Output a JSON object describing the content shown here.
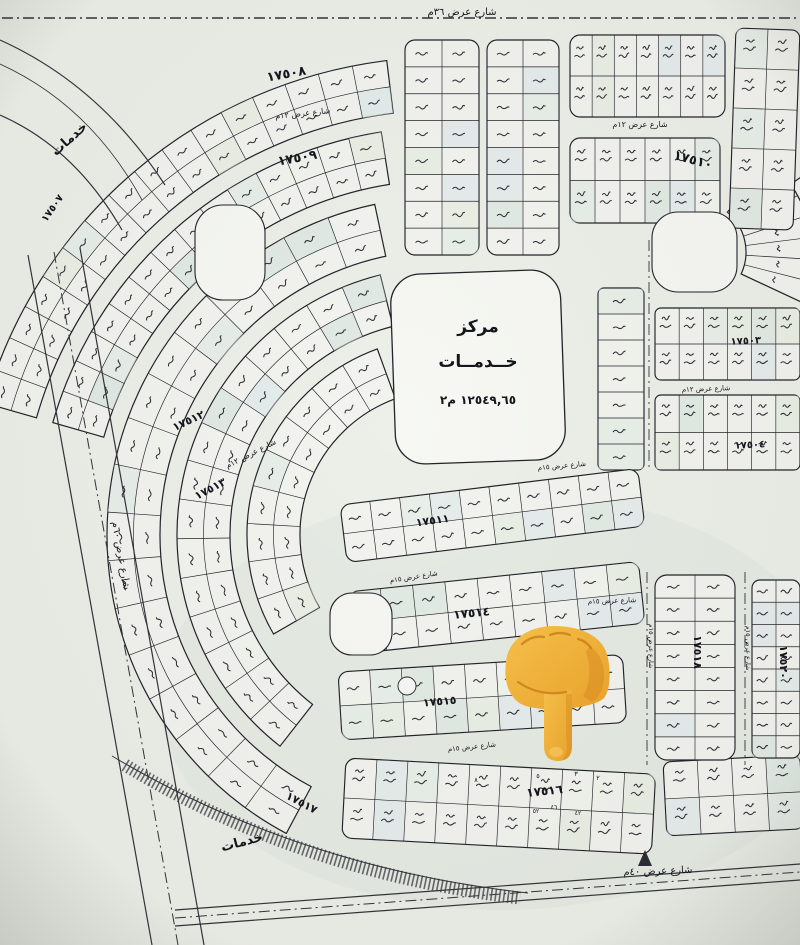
{
  "map_title": "مخطط أراضي سكني",
  "top_boundary_street": "شارع عرض ٣٦م",
  "center_plot": {
    "title_line1": "مركز",
    "title_line2": "خــدمــات",
    "area_text": "١٢٥٤٩,٦٥ م٢"
  },
  "pointer": {
    "icon": "backhand-index-pointing-down-emoji",
    "body_color": "#F3AC35",
    "shade_color": "#D9881F",
    "light_color": "#F9C75A"
  },
  "street_labels": [
    {
      "t": "شارع عرض ٣٦م",
      "x": 462,
      "y": 15,
      "r": 0,
      "s": 10
    },
    {
      "t": "شارع عرض ١٢م",
      "x": 303,
      "y": 116,
      "r": -6,
      "s": 8
    },
    {
      "t": "شارع عرض ١٢م",
      "x": 640,
      "y": 127,
      "r": 0,
      "s": 8
    },
    {
      "t": "شارع عرض ١٢م",
      "x": 706,
      "y": 391,
      "r": -2,
      "s": 7
    },
    {
      "t": "شارع عرض ١٢م",
      "x": 252,
      "y": 456,
      "r": -27,
      "s": 8
    },
    {
      "t": "شارع عرض ١٥م",
      "x": 562,
      "y": 468,
      "r": -5,
      "s": 7
    },
    {
      "t": "شارع عرض ١٥م",
      "x": 414,
      "y": 579,
      "r": -9,
      "s": 7
    },
    {
      "t": "شارع عرض ١٥م",
      "x": 612,
      "y": 603,
      "r": -2,
      "s": 7
    },
    {
      "t": "شارع عرض ١٥م",
      "x": 649,
      "y": 646,
      "r": 90,
      "s": 6.5
    },
    {
      "t": "شارع عرض ١٥م",
      "x": 746,
      "y": 648,
      "r": 90,
      "s": 6.5
    },
    {
      "t": "شارع عرض ١٥م",
      "x": 472,
      "y": 749,
      "r": -6,
      "s": 7
    },
    {
      "t": "شارع عرض ٤٠م",
      "x": 658,
      "y": 874,
      "r": -2,
      "s": 10
    },
    {
      "t": "شارع عرض ٦٠م",
      "x": 118,
      "y": 556,
      "r": 80,
      "s": 10
    }
  ],
  "block_labels": [
    {
      "t": "١٧٥٠٧",
      "x": 55,
      "y": 210,
      "r": -55,
      "s": 10
    },
    {
      "t": "١٧٥٠٨",
      "x": 287,
      "y": 78,
      "r": -10,
      "s": 13
    },
    {
      "t": "١٧٥٠٩",
      "x": 298,
      "y": 162,
      "r": -10,
      "s": 13
    },
    {
      "t": "١٧٥١٠",
      "x": 692,
      "y": 164,
      "r": 15,
      "s": 13
    },
    {
      "t": "١٧٥٠٣",
      "x": 746,
      "y": 344,
      "r": -3,
      "s": 10
    },
    {
      "t": "١٧٥٠٤",
      "x": 750,
      "y": 448,
      "r": -3,
      "s": 10
    },
    {
      "t": "١٧٥١١",
      "x": 433,
      "y": 524,
      "r": -8,
      "s": 11
    },
    {
      "t": "١٧٥١٢",
      "x": 190,
      "y": 424,
      "r": -25,
      "s": 11
    },
    {
      "t": "١٧٥١٣",
      "x": 212,
      "y": 492,
      "r": -28,
      "s": 11
    },
    {
      "t": "١٧٥١٤",
      "x": 472,
      "y": 617,
      "r": -6,
      "s": 12
    },
    {
      "t": "١٧٥١٥",
      "x": 440,
      "y": 705,
      "r": -5,
      "s": 11
    },
    {
      "t": "١٧٥١٦",
      "x": 545,
      "y": 795,
      "r": -6,
      "s": 12
    },
    {
      "t": "١٧٥١٧",
      "x": 300,
      "y": 806,
      "r": 28,
      "s": 11
    },
    {
      "t": "١٧٥١٨",
      "x": 694,
      "y": 652,
      "r": 90,
      "s": 11
    },
    {
      "t": "١٧٥٢٠",
      "x": 780,
      "y": 662,
      "r": 90,
      "s": 11
    }
  ],
  "services_labels": [
    {
      "t": "خدمات",
      "x": 72,
      "y": 142,
      "r": -42,
      "s": 13,
      "sp": 3
    },
    {
      "t": "خدمات",
      "x": 243,
      "y": 846,
      "r": -15,
      "s": 13,
      "sp": 5
    }
  ],
  "plot_numbers": [
    {
      "t": "٨",
      "x": 476,
      "y": 782,
      "s": 6.5
    },
    {
      "t": "٥",
      "x": 538,
      "y": 778,
      "s": 6.5
    },
    {
      "t": "٣",
      "x": 576,
      "y": 776,
      "s": 6.5
    },
    {
      "t": "٢",
      "x": 598,
      "y": 780,
      "s": 6.5
    },
    {
      "t": "٥٢",
      "x": 536,
      "y": 813,
      "s": 6
    },
    {
      "t": "٤٦",
      "x": 554,
      "y": 809,
      "s": 6
    },
    {
      "t": "٤٢",
      "x": 578,
      "y": 815,
      "s": 6
    }
  ],
  "map_geometry": {
    "fans": [
      {
        "cx": 445,
        "cy": 535,
        "r0": 425,
        "r1": 478,
        "a0": 196,
        "a1": 263,
        "cols": 16,
        "rows": 2
      },
      {
        "cx": 445,
        "cy": 535,
        "r0": 355,
        "r1": 408,
        "a0": 196,
        "a1": 261,
        "cols": 14,
        "rows": 2
      },
      {
        "cx": 445,
        "cy": 535,
        "r0": 285,
        "r1": 338,
        "a0": 118,
        "a1": 258,
        "cols": 17,
        "rows": 2
      },
      {
        "cx": 445,
        "cy": 535,
        "r0": 215,
        "r1": 268,
        "a0": 128,
        "a1": 256,
        "cols": 15,
        "rows": 2
      },
      {
        "cx": 445,
        "cy": 535,
        "r0": 145,
        "r1": 198,
        "a0": 150,
        "a1": 250,
        "cols": 9,
        "rows": 2
      },
      {
        "cx": 694,
        "cy": 252,
        "r0": 52,
        "r1": 118,
        "a0": -50,
        "a1": 25,
        "cols": 7,
        "rows": 1
      },
      {
        "cx": 694,
        "cy": 252,
        "r0": 118,
        "r1": 182,
        "a0": -35,
        "a1": 20,
        "cols": 5,
        "rows": 1
      }
    ],
    "grids": [
      {
        "x": 405,
        "y": 40,
        "w": 74,
        "h": 215,
        "rot": 0,
        "rows": 8,
        "cols": 2,
        "rx": 10
      },
      {
        "x": 487,
        "y": 40,
        "w": 72,
        "h": 215,
        "rot": 0,
        "rows": 8,
        "cols": 2,
        "rx": 10
      },
      {
        "x": 570,
        "y": 35,
        "w": 155,
        "h": 82,
        "rot": 0,
        "rows": 2,
        "cols": 7,
        "rx": 10
      },
      {
        "x": 736,
        "y": 28,
        "w": 64,
        "h": 200,
        "rot": 2,
        "rows": 5,
        "cols": 2,
        "rx": 8
      },
      {
        "x": 570,
        "y": 138,
        "w": 150,
        "h": 85,
        "rot": 0,
        "rows": 2,
        "cols": 6,
        "rx": 10
      },
      {
        "x": 598,
        "y": 288,
        "w": 46,
        "h": 182,
        "rot": 0,
        "rows": 7,
        "cols": 1,
        "rx": 6
      },
      {
        "x": 655,
        "y": 308,
        "w": 145,
        "h": 72,
        "rot": 0,
        "rows": 2,
        "cols": 6,
        "rx": 6
      },
      {
        "x": 655,
        "y": 395,
        "w": 145,
        "h": 75,
        "rot": 0,
        "rows": 2,
        "cols": 6,
        "rx": 6
      },
      {
        "x": 340,
        "y": 505,
        "w": 300,
        "h": 58,
        "rot": -7,
        "rows": 2,
        "cols": 10,
        "rx": 10
      },
      {
        "x": 348,
        "y": 592,
        "w": 292,
        "h": 62,
        "rot": -6,
        "rows": 2,
        "cols": 9,
        "rx": 10
      },
      {
        "x": 338,
        "y": 672,
        "w": 285,
        "h": 68,
        "rot": -3.5,
        "rows": 2,
        "cols": 9,
        "rx": 10
      },
      {
        "x": 346,
        "y": 758,
        "w": 310,
        "h": 80,
        "rot": 3,
        "rows": 2,
        "cols": 10,
        "rx": 10
      },
      {
        "x": 663,
        "y": 762,
        "w": 137,
        "h": 74,
        "rot": -3,
        "rows": 2,
        "cols": 4,
        "rx": 8
      },
      {
        "x": 655,
        "y": 575,
        "w": 80,
        "h": 185,
        "rot": 0,
        "rows": 8,
        "cols": 2,
        "rx": 12
      },
      {
        "x": 752,
        "y": 580,
        "w": 48,
        "h": 178,
        "rot": 0,
        "rows": 8,
        "cols": 2,
        "rx": 8
      }
    ],
    "parks": [
      {
        "x": 195,
        "y": 205,
        "w": 70,
        "h": 95,
        "rx": 28
      },
      {
        "x": 652,
        "y": 212,
        "w": 85,
        "h": 80,
        "rx": 26
      },
      {
        "x": 330,
        "y": 593,
        "w": 62,
        "h": 62,
        "rx": 22
      }
    ],
    "circle_park": {
      "x": 407,
      "y": 686,
      "r": 9
    },
    "center_plot_shape": {
      "x": 393,
      "y": 272,
      "w": 170,
      "h": 190,
      "rx": 30
    },
    "paths": [
      {
        "d": "M2,18 H798",
        "style": "dashdot",
        "sw": 1.6
      },
      {
        "d": "M28,255 L152,945",
        "style": "solid",
        "sw": 1.2
      },
      {
        "d": "M80,248 L204,945",
        "style": "solid",
        "sw": 1.2
      },
      {
        "d": "M54,252 L178,945",
        "style": "dashdot",
        "sw": 1
      },
      {
        "d": "M175,910 L800,864",
        "style": "solid",
        "sw": 1.2
      },
      {
        "d": "M175,926 L800,880",
        "style": "solid",
        "sw": 1.2
      },
      {
        "d": "M175,918 L800,872",
        "style": "dashdot",
        "sw": 1
      },
      {
        "d": "M0,40 Q100,85 165,185",
        "style": "solid",
        "sw": 1.2
      },
      {
        "d": "M0,64 Q90,105 142,200",
        "style": "solid",
        "sw": 0.8
      },
      {
        "d": "M0,115 Q75,148 122,230",
        "style": "solid",
        "sw": 1.2
      },
      {
        "d": "M112,756 Q300,868 528,893",
        "style": "solid",
        "sw": 1
      },
      {
        "d": "M125,765 Q300,872 520,898",
        "style": "hatch",
        "sw": 13
      },
      {
        "d": "M649,240 V470",
        "style": "dashdot",
        "sw": 0.9
      },
      {
        "d": "M647,572 V765",
        "style": "dashdot",
        "sw": 0.9
      },
      {
        "d": "M745,572 V765",
        "style": "dashdot",
        "sw": 0.9
      },
      {
        "d": "M645,850 l-7,16 h14 Z",
        "style": "fill",
        "sw": 0
      }
    ]
  }
}
